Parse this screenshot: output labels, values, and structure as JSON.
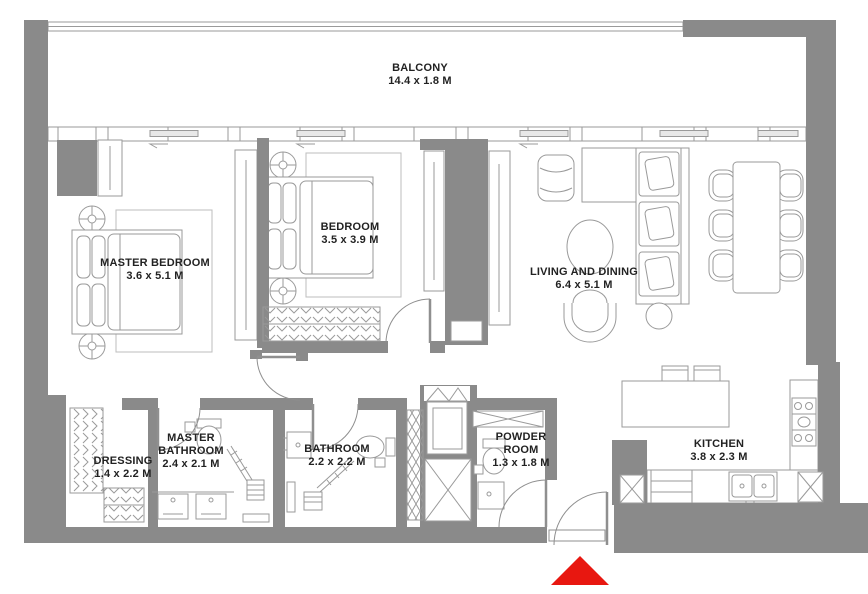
{
  "plan": {
    "type": "apartment-floor-plan",
    "rooms": [
      {
        "id": "balcony",
        "name": "BALCONY",
        "dims": "14.4 x 1.8 M"
      },
      {
        "id": "master-bedroom",
        "name": "MASTER BEDROOM",
        "dims": "3.6 x 5.1 M"
      },
      {
        "id": "bedroom",
        "name": "BEDROOM",
        "dims": "3.5 x 3.9 M"
      },
      {
        "id": "living-dining",
        "name": "LIVING AND DINING",
        "dims": "6.4 x 5.1 M"
      },
      {
        "id": "dressing",
        "name": "DRESSING",
        "dims": "1.4 x 2.2 M"
      },
      {
        "id": "master-bathroom",
        "name": "MASTER BATHROOM",
        "dims": "2.4 x 2.1 M"
      },
      {
        "id": "bathroom",
        "name": "BATHROOM",
        "dims": "2.2 x 2.2 M"
      },
      {
        "id": "powder-room",
        "name": "POWDER ROOM",
        "dims": "1.3 x 1.8 M"
      },
      {
        "id": "kitchen",
        "name": "KITCHEN",
        "dims": "3.8 x 2.3 M"
      }
    ],
    "entrance": {
      "marker": "entrance-arrow"
    },
    "colors": {
      "wall": "#8a8a8a",
      "furniture_line": "#9a9a9a",
      "text": "#222222",
      "entrance_arrow": "#e81710",
      "background": "#ffffff"
    }
  }
}
